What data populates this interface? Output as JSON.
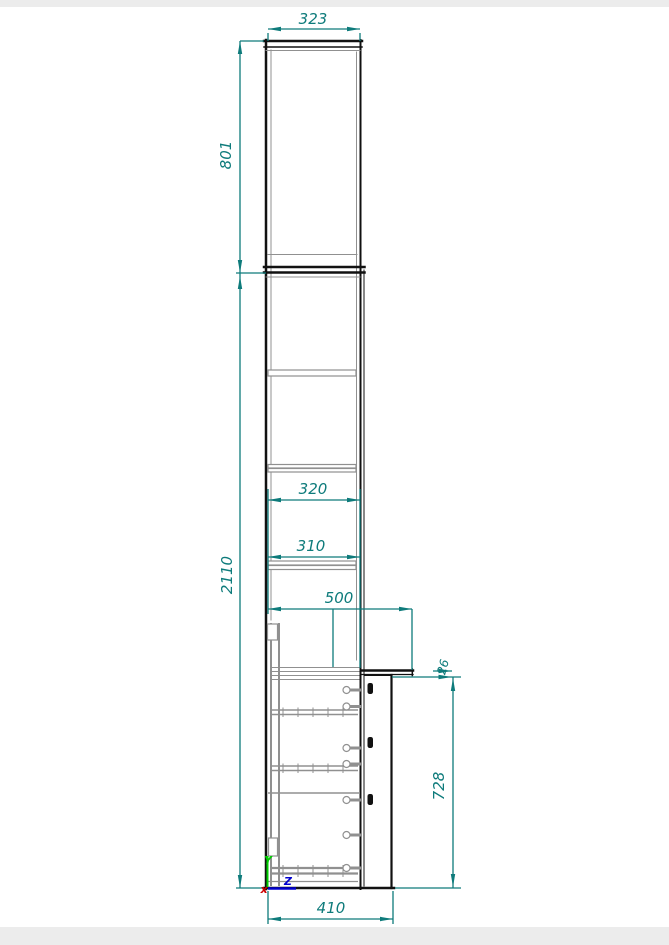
{
  "drawing": {
    "dimensions": {
      "top_width": "323",
      "upper_section_height": "801",
      "total_height": "2110",
      "shelf_depth_upper": "320",
      "shelf_depth_lower": "310",
      "base_open_depth": "500",
      "counter_thickness": "26",
      "base_height": "728",
      "base_depth": "410"
    },
    "ucs": {
      "y_label": "Y",
      "z_label": "Z",
      "x_label": "x"
    },
    "colors": {
      "dimension": "#0e7b7b",
      "outline": "#111111",
      "detail": "#909090",
      "axis_y": "#00cd00",
      "axis_z": "#0000cd",
      "axis_x": "#cd0000",
      "margin_band": "#ececec",
      "paper": "#ffffff"
    }
  }
}
